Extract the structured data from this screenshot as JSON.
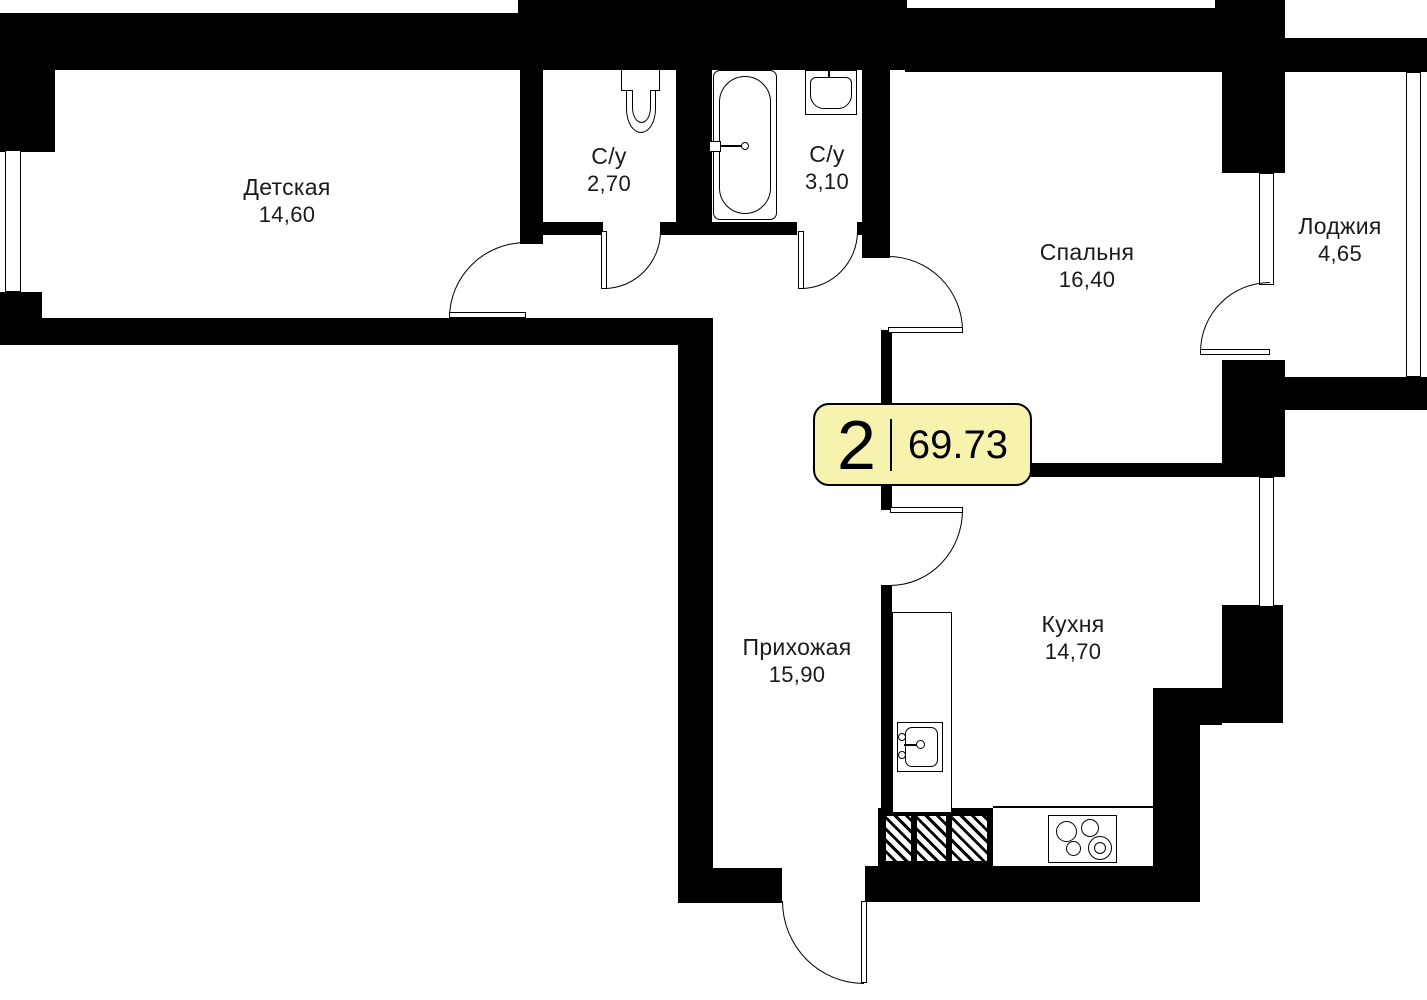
{
  "plan": {
    "type": "apartment-floor-plan",
    "badge": {
      "rooms_count": "2",
      "total_area": "69.73"
    },
    "rooms": [
      {
        "id": "detskaya",
        "name": "Детская",
        "area": "14,60"
      },
      {
        "id": "su-small",
        "name": "С/у",
        "area": "2,70"
      },
      {
        "id": "su-big",
        "name": "С/у",
        "area": "3,10"
      },
      {
        "id": "spalnya",
        "name": "Спальня",
        "area": "16,40"
      },
      {
        "id": "loggia",
        "name": "Лоджия",
        "area": "4,65"
      },
      {
        "id": "prihozhaya",
        "name": "Прихожая",
        "area": "15,90"
      },
      {
        "id": "kuhnya",
        "name": "Кухня",
        "area": "14,70"
      }
    ],
    "fixtures": [
      "toilet",
      "bathtub",
      "sink",
      "kitchen-sink",
      "stove",
      "counter",
      "vent-shaft"
    ],
    "colors": {
      "wall": "#000000",
      "badge_bg": "#F8F2AF",
      "text": "#1A1A1A"
    }
  }
}
